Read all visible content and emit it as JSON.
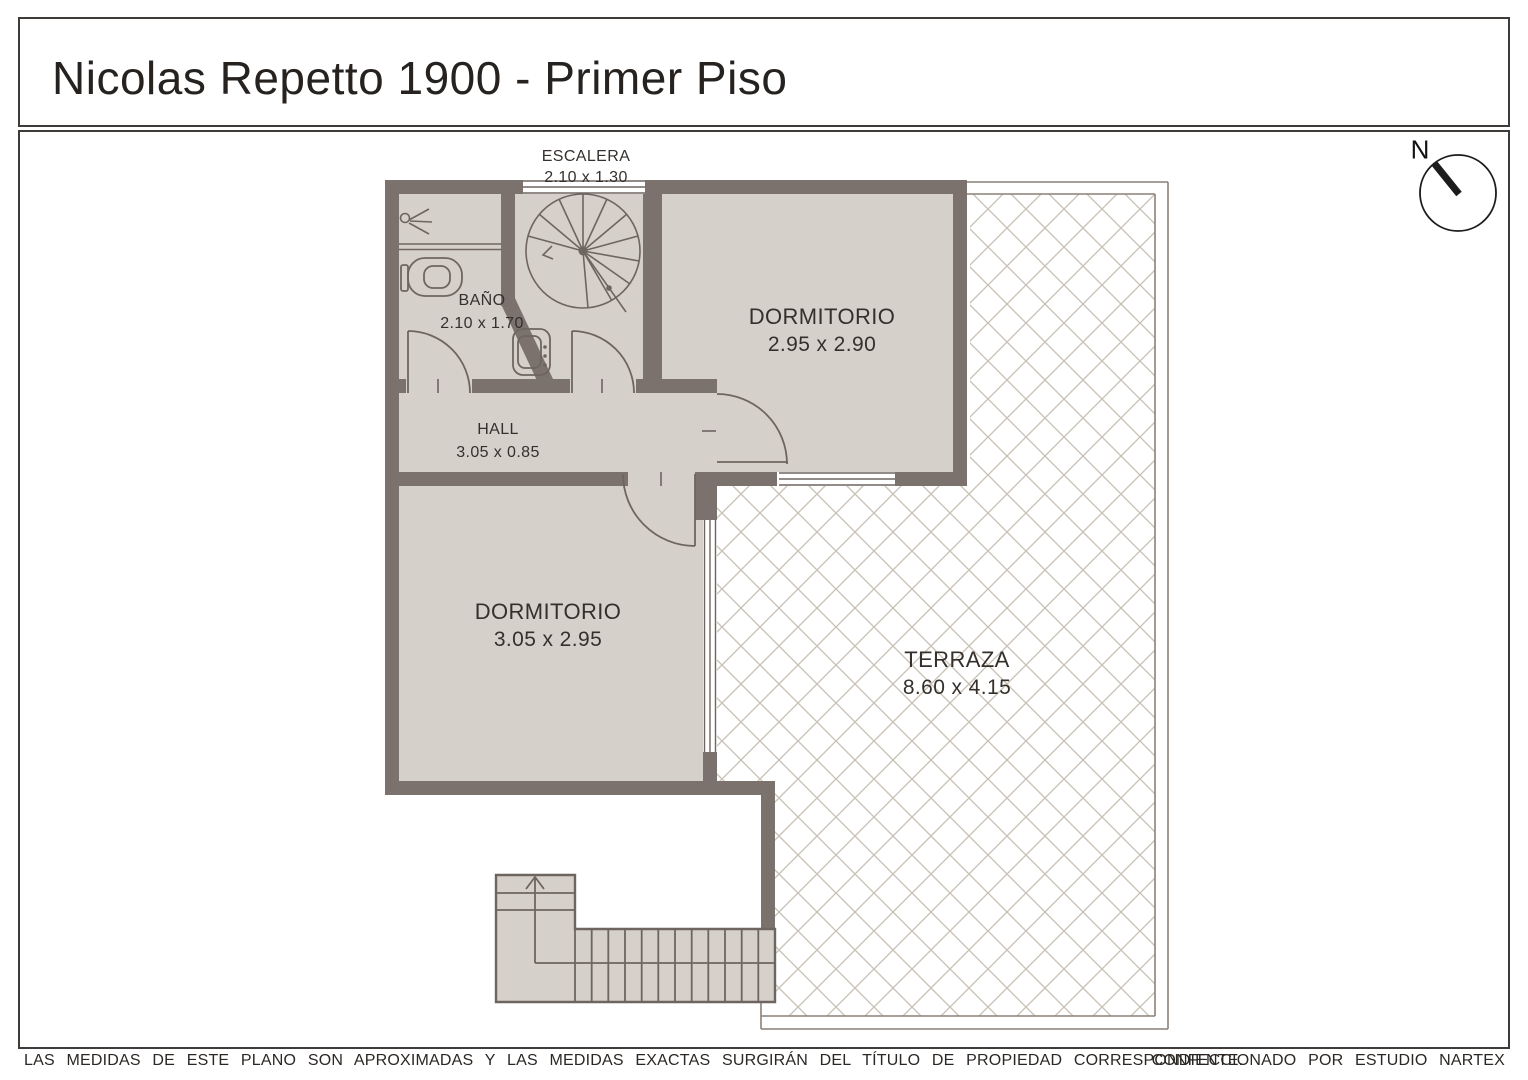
{
  "title": "Nicolas Repetto 1900 - Primer Piso",
  "compass": {
    "north_label": "N"
  },
  "rooms": [
    {
      "id": "escalera",
      "label": "ESCALERA",
      "dims": "2.10 x 1.30"
    },
    {
      "id": "banio",
      "label": "BAÑO",
      "dims": "2.10 x 1.70"
    },
    {
      "id": "hall",
      "label": "HALL",
      "dims": "3.05 x 0.85"
    },
    {
      "id": "dormitorio_1",
      "label": "DORMITORIO",
      "dims": "2.95 x 2.90"
    },
    {
      "id": "dormitorio_2",
      "label": "DORMITORIO",
      "dims": "3.05 x 2.95"
    },
    {
      "id": "terraza",
      "label": "TERRAZA",
      "dims": "8.60 x 4.15"
    }
  ],
  "footer": {
    "disclaimer": "LAS MEDIDAS DE ESTE PLANO SON APROXIMADAS Y LAS MEDIDAS EXACTAS SURGIRÁN DEL TÍTULO DE PROPIEDAD CORRESPONDIENTE.",
    "credit": "CONFECCIONADO POR ESTUDIO NARTEX"
  },
  "colors": {
    "wall": "#7b726d",
    "floor": "#d6d0ca",
    "hatch_line": "#c9c0b6",
    "thin_border": "#8a8178",
    "ink": "#35302c"
  }
}
